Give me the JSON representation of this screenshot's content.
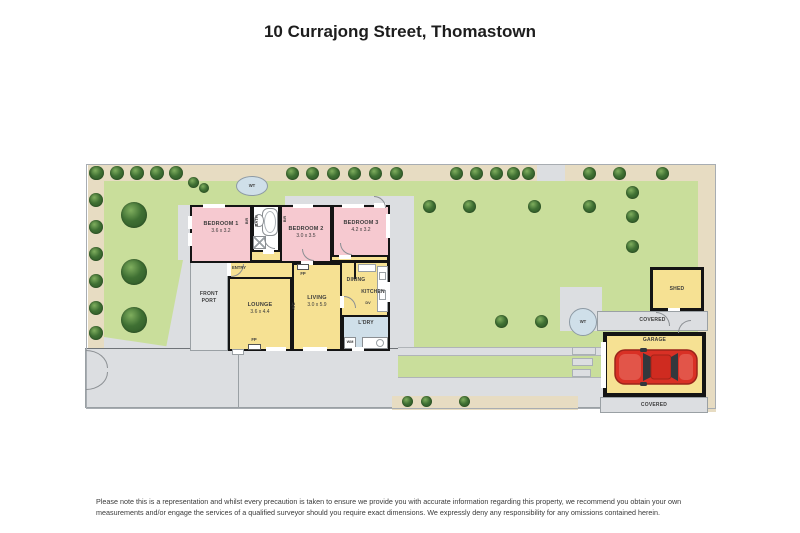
{
  "title": "10 Currajong Street, Thomastown",
  "disclaimer": "Please note this is a representation and whilst every precaution is taken to ensure we provide you with accurate information regarding this property, we recommend you obtain your own measurements and/or engage the services of a qualified surveyor should you require exact dimensions. We expressly deny any responsibility for any omissions contained herein.",
  "colors": {
    "lawn": "#c9de9b",
    "path": "#e7dcc2",
    "concrete": "#dcdee1",
    "wall": "#141414",
    "bedroom": "#f6c9d0",
    "living_area": "#f6e193",
    "wet_area": "#cfdfe9",
    "tree": "#3f7033",
    "car": "#d93025"
  },
  "rooms": {
    "bedroom1": {
      "name": "BEDROOM 1",
      "dims": "3.6 x 3.2"
    },
    "bedroom2": {
      "name": "BEDROOM 2",
      "dims": "3.0 x 3.5"
    },
    "bedroom3": {
      "name": "BEDROOM 3",
      "dims": "4.2 x 3.2"
    },
    "lounge": {
      "name": "LOUNGE",
      "dims": "3.6 x 4.4"
    },
    "living": {
      "name": "LIVING",
      "dims": "3.0 x 5.9"
    },
    "dining": {
      "name": "DINING"
    },
    "kitchen": {
      "name": "KITCHEN"
    },
    "laundry": {
      "name": "L'DRY"
    },
    "bath": {
      "name": "BATH"
    },
    "entry": {
      "name": "ENTRY"
    },
    "front_porch": {
      "line1": "FRONT",
      "line2": "PORT"
    }
  },
  "outbuildings": {
    "shed": "SHED",
    "garage": "GARAGE",
    "covered_upper": "COVERED",
    "covered_lower": "COVERED"
  },
  "markers": {
    "water_tank": "WT",
    "fireplace": "FP",
    "air_conditioner": "A/C",
    "dishwasher": "DV",
    "washing_machine": "WM",
    "built_in_robe": "BIR"
  }
}
